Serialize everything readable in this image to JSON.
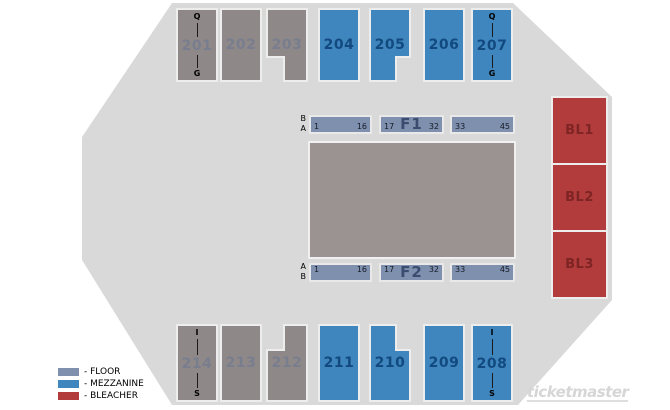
{
  "map": {
    "top_row": [
      {
        "label": "201",
        "top_label": "Q",
        "bottom_label": "G"
      },
      {
        "label": "202"
      },
      {
        "label": "203"
      },
      {
        "label": "204"
      },
      {
        "label": "205"
      },
      {
        "label": "206"
      },
      {
        "label": "207",
        "top_label": "Q",
        "bottom_label": "G"
      }
    ],
    "bottom_row": [
      {
        "label": "214",
        "top_label": "I",
        "bottom_label": "S"
      },
      {
        "label": "213"
      },
      {
        "label": "212"
      },
      {
        "label": "211"
      },
      {
        "label": "210"
      },
      {
        "label": "209"
      },
      {
        "label": "208",
        "top_label": "I",
        "bottom_label": "S"
      }
    ],
    "bleachers": [
      {
        "label": "BL1"
      },
      {
        "label": "BL2"
      },
      {
        "label": "BL3"
      }
    ],
    "floor_f1": {
      "side_label_top": "B",
      "side_label_bottom": "A",
      "blocks": [
        {
          "left": "1",
          "right": "16"
        },
        {
          "left": "17",
          "center": "F1",
          "right": "32"
        },
        {
          "left": "33",
          "right": "45"
        }
      ]
    },
    "floor_f2": {
      "side_label_top": "A",
      "side_label_bottom": "B",
      "blocks": [
        {
          "left": "1",
          "right": "16"
        },
        {
          "left": "17",
          "center": "F2",
          "right": "32"
        },
        {
          "left": "33",
          "right": "45"
        }
      ]
    }
  },
  "legend": {
    "items": [
      {
        "key": "floor",
        "label": "- FLOOR",
        "color": "#7E90AE"
      },
      {
        "key": "mezzanine",
        "label": "- MEZZANINE",
        "color": "#3E86BD"
      },
      {
        "key": "bleacher",
        "label": "- BLEACHER",
        "color": "#B23C3C"
      }
    ]
  },
  "watermark": "ticketmaster",
  "colors": {
    "arena_background": "#D9D9D9",
    "floor_section": "#8F8889",
    "mezzanine_section": "#3E86BD",
    "bleacher_section": "#B23C3C",
    "floor_strip": "#7E90AE",
    "stage_slab": "#9B9292"
  }
}
